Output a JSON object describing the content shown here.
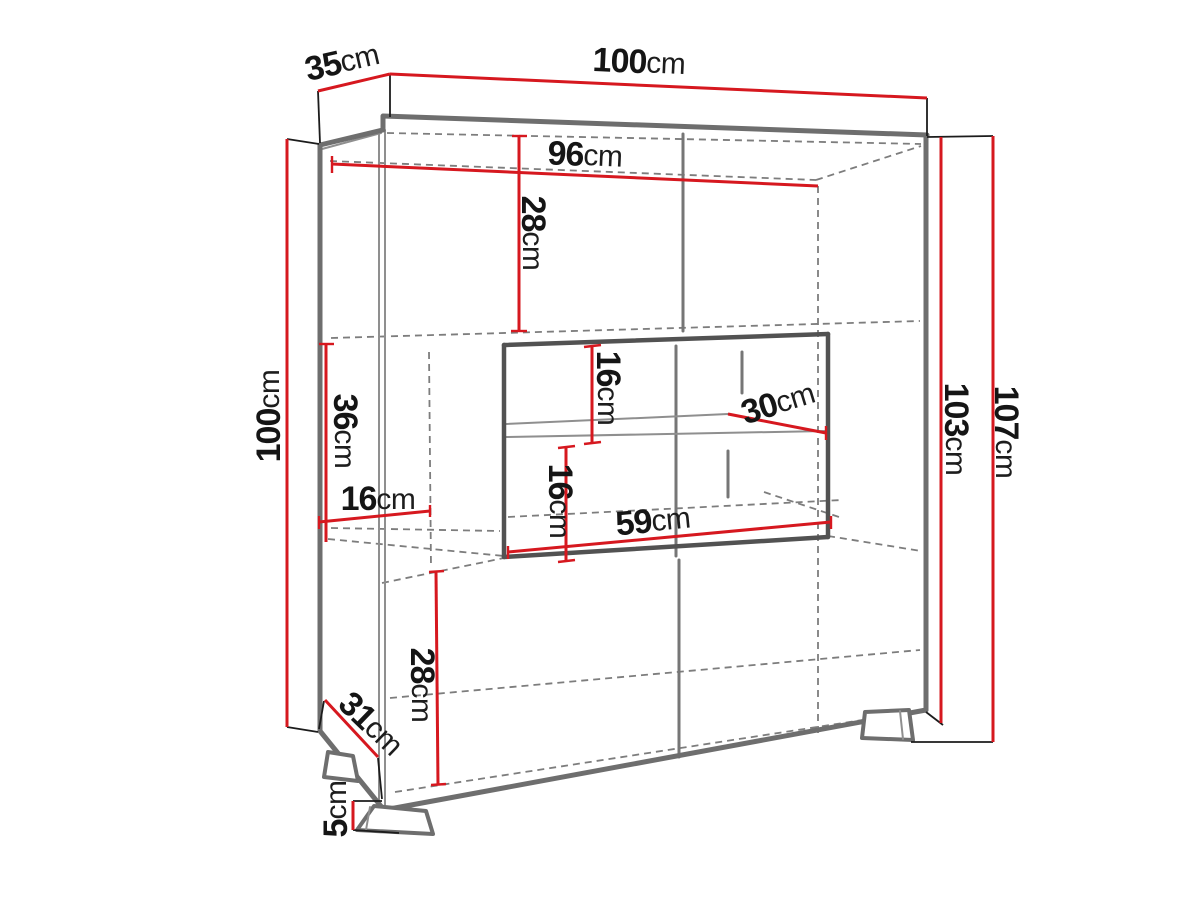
{
  "diagram": {
    "kind": "furniture-dimension-drawing",
    "unit": "cm",
    "colors": {
      "dimension_red": "#d6181f",
      "cabinet_gray": "#6e6e6e",
      "niche_gray": "#525252",
      "hidden_dashed_gray": "#7d7d7d",
      "text_black": "#151515",
      "background": "#ffffff"
    },
    "dims": {
      "depth_top": {
        "value": "35",
        "unit": "cm"
      },
      "width_top": {
        "value": "100",
        "unit": "cm"
      },
      "interior_width": {
        "value": "96",
        "unit": "cm"
      },
      "top_section_height": {
        "value": "28",
        "unit": "cm"
      },
      "left_height": {
        "value": "100",
        "unit": "cm"
      },
      "middle_left_height": {
        "value": "36",
        "unit": "cm"
      },
      "left_shelf_width": {
        "value": "16",
        "unit": "cm"
      },
      "niche_upper_height": {
        "value": "16",
        "unit": "cm"
      },
      "niche_shelf_depth": {
        "value": "30",
        "unit": "cm"
      },
      "niche_lower_height": {
        "value": "16",
        "unit": "cm"
      },
      "niche_width": {
        "value": "59",
        "unit": "cm"
      },
      "right_body_height": {
        "value": "103",
        "unit": "cm"
      },
      "right_total_height": {
        "value": "107",
        "unit": "cm"
      },
      "bottom_depth": {
        "value": "31",
        "unit": "cm"
      },
      "bottom_section_height": {
        "value": "28",
        "unit": "cm"
      },
      "feet_height": {
        "value": "5",
        "unit": "cm"
      }
    }
  }
}
